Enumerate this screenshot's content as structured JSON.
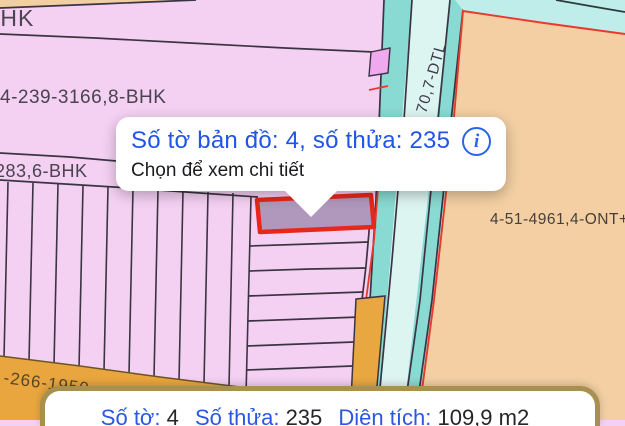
{
  "colors": {
    "accent_blue": "#2154e8",
    "highlight_red": "#e7271a",
    "highlight_fill": "#b098bd",
    "parcel_pink": "#f4d0f2",
    "parcel_tan": "#f3cfa2",
    "parcel_orange": "#e9a742",
    "road_cyan": "#89dad2",
    "road_pale": "#ddf5f1",
    "sheet_border": "#a8914f"
  },
  "map": {
    "labels": {
      "top_left": "BHK",
      "parcel_large": "4-239-3166,8-BHK",
      "parcel_band": "283,6-BHK",
      "road": "70,7-DTL",
      "parcel_right": "4-51-4961,4-ONT+C",
      "bottom_band": "-266-1950"
    }
  },
  "popup": {
    "title": "Số tờ bản đồ: 4, số thửa: 235",
    "subtitle": "Chọn để xem chi tiết",
    "info_glyph": "i"
  },
  "bottom_sheet": {
    "sheet_label": "Số tờ:",
    "sheet_value": "4",
    "parcel_label": "Số thửa:",
    "parcel_value": "235",
    "area_label": "Diện tích:",
    "area_value": "109,9 m2"
  }
}
